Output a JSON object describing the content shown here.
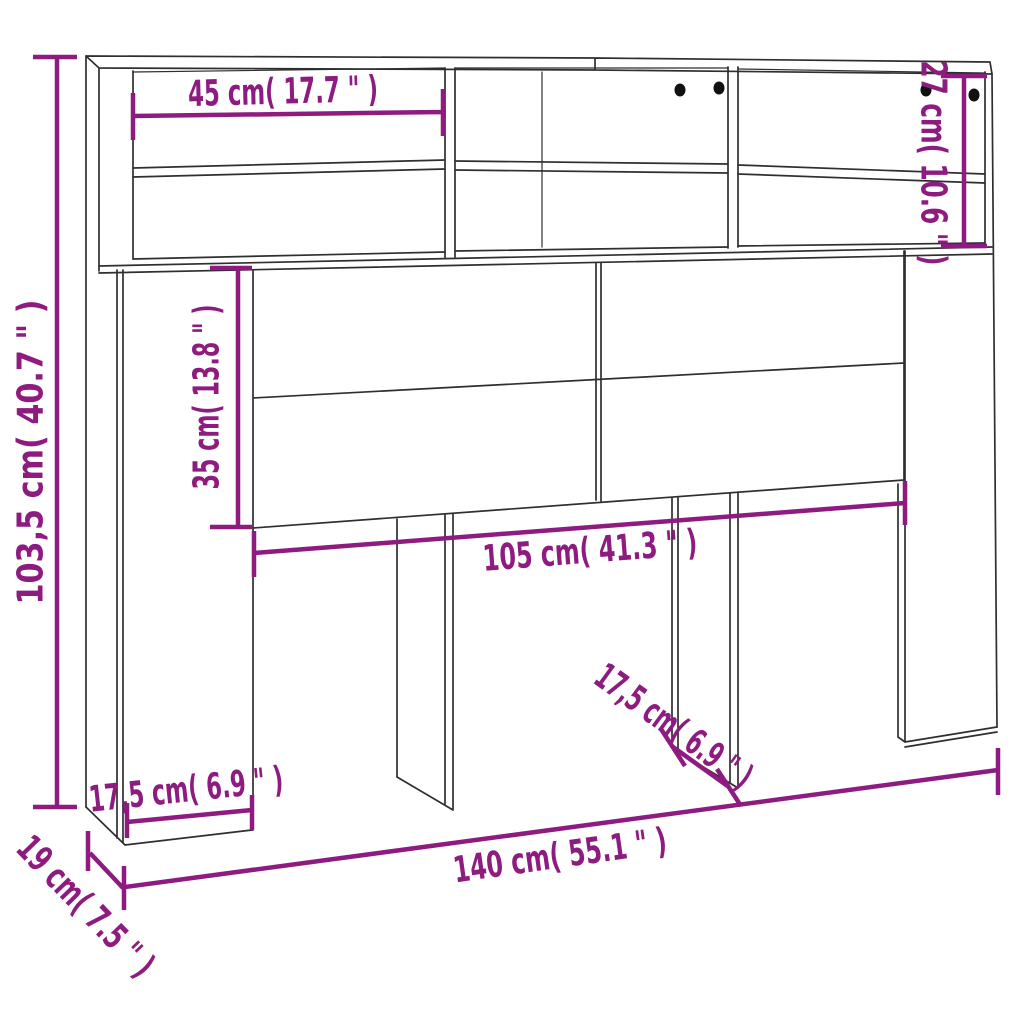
{
  "diagram": {
    "kind": "product dimension drawing",
    "subject": "headboard cabinet with shelf compartments and legs",
    "background_color": "#ffffff",
    "drawing_line_color": "#2f2f2f",
    "dimension_color": "#8E1B80",
    "drill_hole_color": "#111111",
    "drill_hole_count": 4,
    "dimensions": {
      "overall_height": {
        "label": "103,5 cm( 40.7 \" )",
        "cm": "103,5",
        "inch": "40.7"
      },
      "shelf_width": {
        "label": "45 cm( 17.7 \" )",
        "cm": "45",
        "inch": "17.7"
      },
      "hutch_height": {
        "label": "27 cm( 10.6 \" )",
        "cm": "27",
        "inch": "10.6"
      },
      "panel_height": {
        "label": "35 cm( 13.8 \" )",
        "cm": "35",
        "inch": "13.8"
      },
      "panel_width": {
        "label": "105 cm( 41.3 \" )",
        "cm": "105",
        "inch": "41.3"
      },
      "mid_leg_depth": {
        "label": "17,5 cm( 6.9 \" )",
        "cm": "17,5",
        "inch": "6.9"
      },
      "overall_width": {
        "label": "140 cm( 55.1 \" )",
        "cm": "140",
        "inch": "55.1"
      },
      "left_side_depth": {
        "label": "17,5 cm( 6.9 \" )",
        "cm": "17,5",
        "inch": "6.9"
      },
      "base_depth": {
        "label": "19 cm( 7.5 \" )",
        "cm": "19",
        "inch": "7.5"
      }
    }
  }
}
